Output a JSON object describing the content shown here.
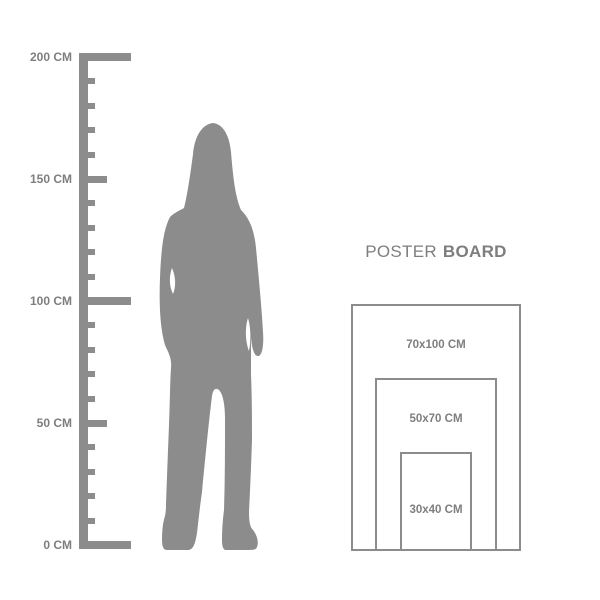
{
  "colors": {
    "background": "#ffffff",
    "graphic_gray": "#8c8c8c",
    "text_gray": "#7e7e7e"
  },
  "ruler": {
    "unit": "CM",
    "min_cm": 0,
    "max_cm": 200,
    "tick_step_cm": 10,
    "major_every_cm": 100,
    "mid_every_cm": 50,
    "labeled_ticks": [
      {
        "cm": 200,
        "label": "200 CM"
      },
      {
        "cm": 150,
        "label": "150 CM"
      },
      {
        "cm": 100,
        "label": "100 CM"
      },
      {
        "cm": 50,
        "label": "50 CM"
      },
      {
        "cm": 0,
        "label": "0 CM"
      }
    ]
  },
  "figure": {
    "description": "gray silhouette of a standing woman with long hair, approx 175 cm tall against the ruler"
  },
  "poster_board": {
    "title_regular": "POSTER",
    "title_bold": "BOARD",
    "sizes": [
      {
        "label": "70x100 CM",
        "width_cm": 70,
        "height_cm": 100
      },
      {
        "label": "50x70 CM",
        "width_cm": 50,
        "height_cm": 70
      },
      {
        "label": "30x40 CM",
        "width_cm": 30,
        "height_cm": 40
      }
    ]
  }
}
